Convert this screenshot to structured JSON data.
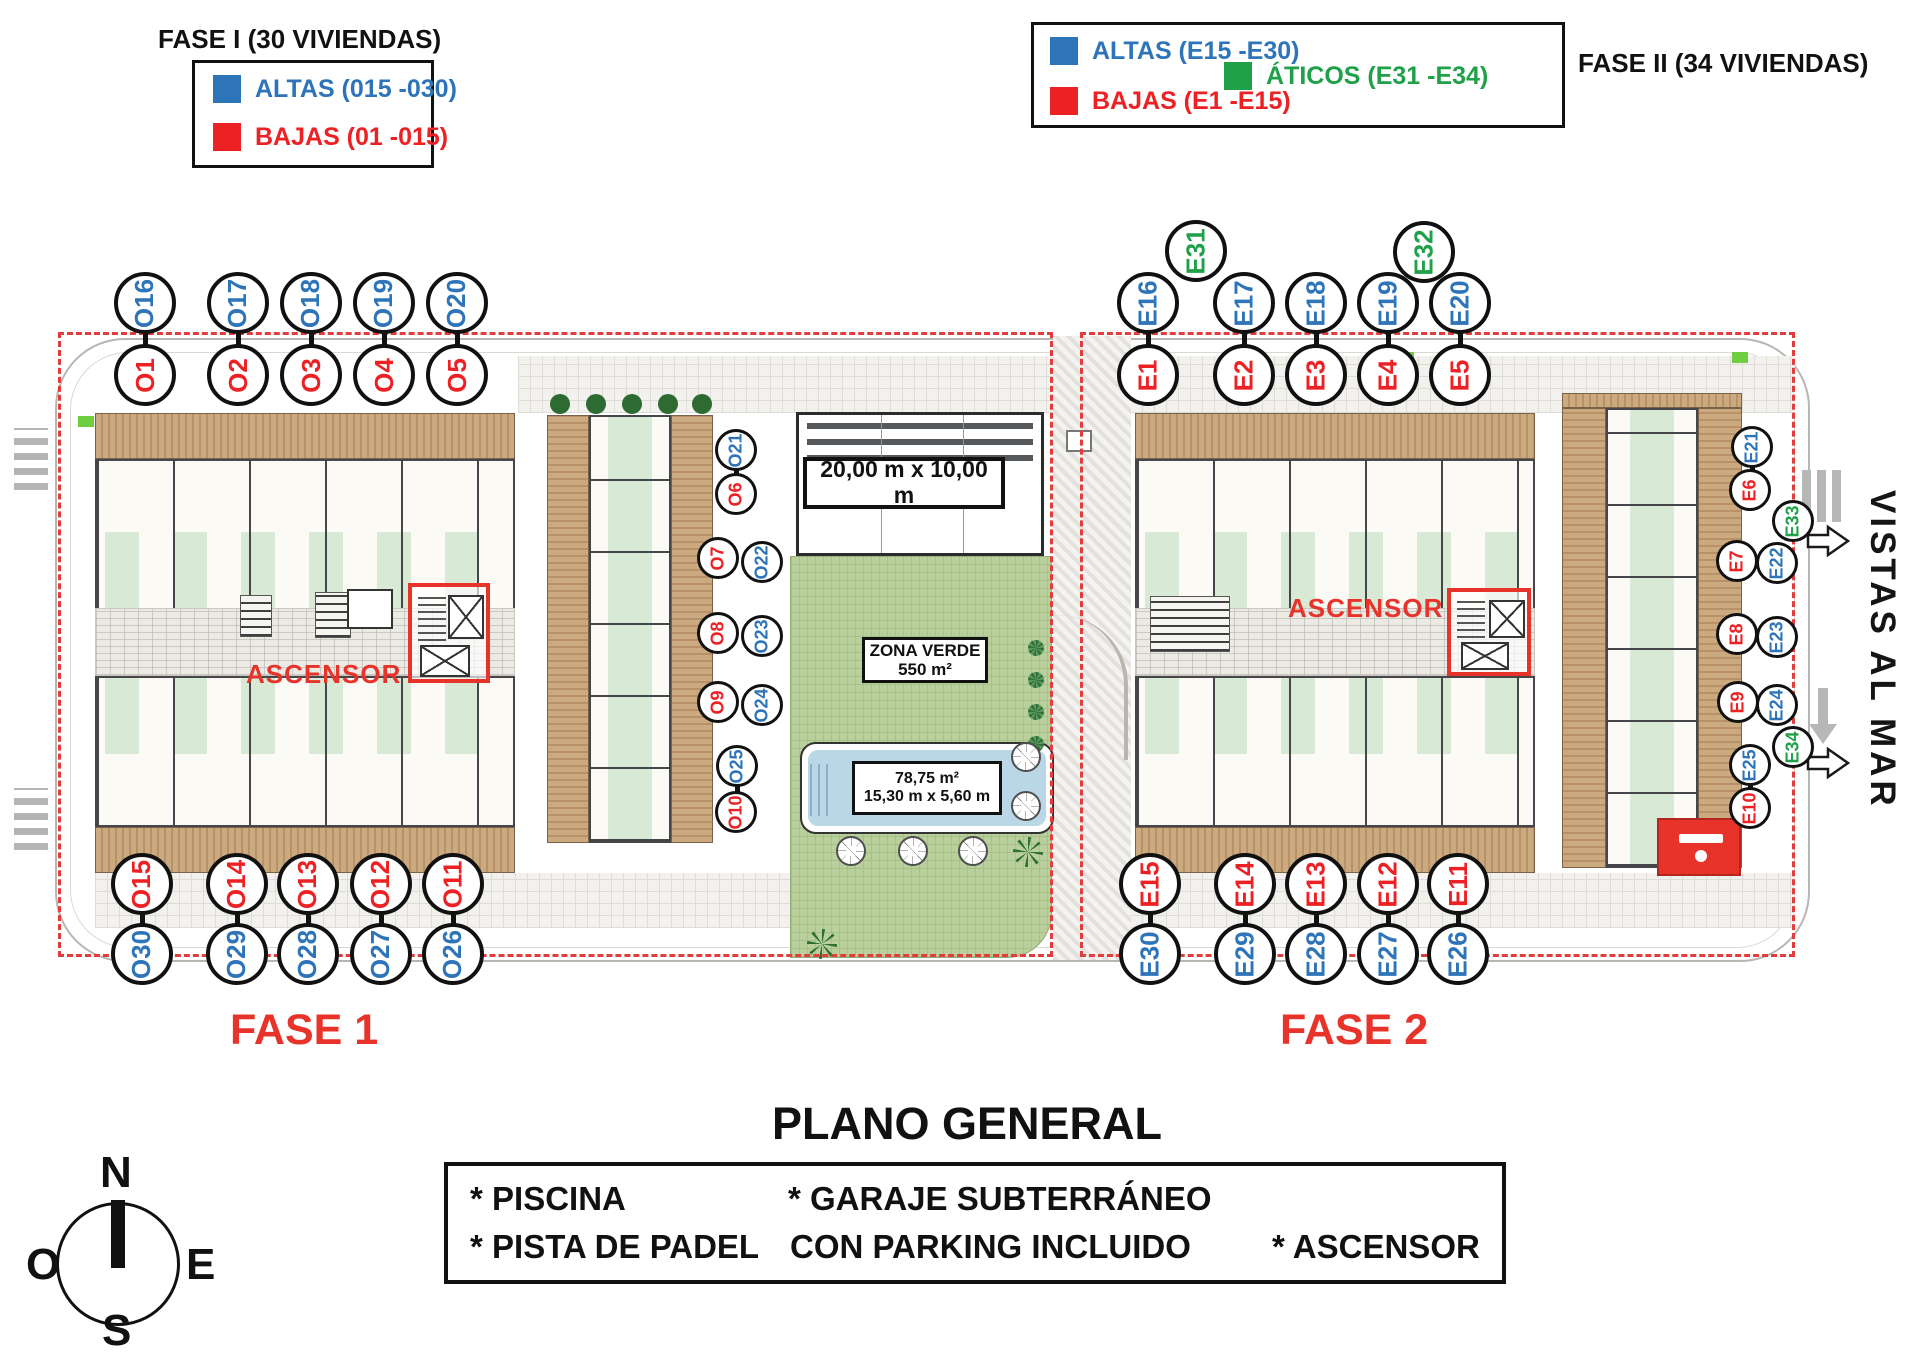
{
  "title": "PLANO GENERAL",
  "palette": {
    "blue": "#2e74b8",
    "red": "#ed2024",
    "green": "#21a04a",
    "dash_red": "#e23c3c",
    "accent_red": "#e8332a"
  },
  "legend_fase1": {
    "title": "FASE I (30 VIVIENDAS)",
    "items": [
      {
        "label": "ALTAS (015 -030)",
        "color": "blue"
      },
      {
        "label": "BAJAS (01 -015)",
        "color": "red"
      }
    ]
  },
  "legend_fase2": {
    "title": "FASE II (34 VIVIENDAS)",
    "items": [
      {
        "label": "ALTAS (E15 -E30)",
        "color": "blue"
      },
      {
        "label": "BAJAS (E1 -E15)",
        "color": "red"
      },
      {
        "label": "ÁTICOS (E31 -E34)",
        "color": "green"
      }
    ]
  },
  "plan": {
    "fase1": "FASE 1",
    "fase2": "FASE 2",
    "ascensor_f1": "ASCENSOR",
    "ascensor_f2": "ASCENSOR",
    "vistas": "VISTAS AL MAR",
    "padel_dim": "20,00 m x 10,00 m",
    "zona_verde": "ZONA VERDE",
    "zona_area": "550 m²",
    "pool_area": "78,75 m²",
    "pool_dim": "15,30 m x 5,60 m"
  },
  "footer_box": {
    "piscina": "* PISCINA",
    "garaje": "* GARAJE SUBTERRÁNEO",
    "pista": "* PISTA DE PADEL",
    "parking": "CON PARKING INCLUIDO",
    "ascensor": "* ASCENSOR"
  },
  "compass": {
    "n": "N",
    "e": "E",
    "s": "S",
    "o": "O"
  },
  "unit_circles": [
    {
      "id": "O16",
      "x": 145,
      "y": 303,
      "r": 31,
      "color": "blue"
    },
    {
      "id": "O1",
      "x": 145,
      "y": 375,
      "r": 31,
      "color": "red"
    },
    {
      "id": "O17",
      "x": 238,
      "y": 303,
      "r": 31,
      "color": "blue"
    },
    {
      "id": "O2",
      "x": 238,
      "y": 375,
      "r": 31,
      "color": "red"
    },
    {
      "id": "O18",
      "x": 311,
      "y": 303,
      "r": 31,
      "color": "blue"
    },
    {
      "id": "O3",
      "x": 311,
      "y": 375,
      "r": 31,
      "color": "red"
    },
    {
      "id": "O19",
      "x": 384,
      "y": 303,
      "r": 31,
      "color": "blue"
    },
    {
      "id": "O4",
      "x": 384,
      "y": 375,
      "r": 31,
      "color": "red"
    },
    {
      "id": "O20",
      "x": 457,
      "y": 303,
      "r": 31,
      "color": "blue"
    },
    {
      "id": "O5",
      "x": 457,
      "y": 375,
      "r": 31,
      "color": "red"
    },
    {
      "id": "O21",
      "x": 736,
      "y": 450,
      "r": 21,
      "color": "blue"
    },
    {
      "id": "O6",
      "x": 736,
      "y": 494,
      "r": 21,
      "color": "red"
    },
    {
      "id": "O7",
      "x": 718,
      "y": 558,
      "r": 21,
      "color": "red"
    },
    {
      "id": "O22",
      "x": 762,
      "y": 562,
      "r": 21,
      "color": "blue"
    },
    {
      "id": "O8",
      "x": 718,
      "y": 633,
      "r": 21,
      "color": "red"
    },
    {
      "id": "O23",
      "x": 762,
      "y": 636,
      "r": 21,
      "color": "blue"
    },
    {
      "id": "O9",
      "x": 718,
      "y": 702,
      "r": 21,
      "color": "red"
    },
    {
      "id": "O24",
      "x": 762,
      "y": 705,
      "r": 21,
      "color": "blue"
    },
    {
      "id": "O25",
      "x": 737,
      "y": 766,
      "r": 21,
      "color": "blue"
    },
    {
      "id": "O10",
      "x": 736,
      "y": 812,
      "r": 21,
      "color": "red"
    },
    {
      "id": "O15",
      "x": 142,
      "y": 884,
      "r": 31,
      "color": "red"
    },
    {
      "id": "O30",
      "x": 142,
      "y": 954,
      "r": 31,
      "color": "blue"
    },
    {
      "id": "O14",
      "x": 237,
      "y": 884,
      "r": 31,
      "color": "red"
    },
    {
      "id": "O29",
      "x": 237,
      "y": 954,
      "r": 31,
      "color": "blue"
    },
    {
      "id": "O13",
      "x": 308,
      "y": 884,
      "r": 31,
      "color": "red"
    },
    {
      "id": "O28",
      "x": 308,
      "y": 954,
      "r": 31,
      "color": "blue"
    },
    {
      "id": "O12",
      "x": 381,
      "y": 884,
      "r": 31,
      "color": "red"
    },
    {
      "id": "O27",
      "x": 381,
      "y": 954,
      "r": 31,
      "color": "blue"
    },
    {
      "id": "O11",
      "x": 453,
      "y": 884,
      "r": 31,
      "color": "red"
    },
    {
      "id": "O26",
      "x": 453,
      "y": 954,
      "r": 31,
      "color": "blue"
    },
    {
      "id": "E31",
      "x": 1196,
      "y": 251,
      "r": 31,
      "color": "green"
    },
    {
      "id": "E32",
      "x": 1424,
      "y": 252,
      "r": 31,
      "color": "green"
    },
    {
      "id": "E16",
      "x": 1148,
      "y": 303,
      "r": 31,
      "color": "blue"
    },
    {
      "id": "E1",
      "x": 1148,
      "y": 375,
      "r": 31,
      "color": "red"
    },
    {
      "id": "E17",
      "x": 1244,
      "y": 303,
      "r": 31,
      "color": "blue"
    },
    {
      "id": "E2",
      "x": 1244,
      "y": 375,
      "r": 31,
      "color": "red"
    },
    {
      "id": "E18",
      "x": 1316,
      "y": 303,
      "r": 31,
      "color": "blue"
    },
    {
      "id": "E3",
      "x": 1316,
      "y": 375,
      "r": 31,
      "color": "red"
    },
    {
      "id": "E19",
      "x": 1388,
      "y": 303,
      "r": 31,
      "color": "blue"
    },
    {
      "id": "E4",
      "x": 1388,
      "y": 375,
      "r": 31,
      "color": "red"
    },
    {
      "id": "E20",
      "x": 1460,
      "y": 303,
      "r": 31,
      "color": "blue"
    },
    {
      "id": "E5",
      "x": 1460,
      "y": 375,
      "r": 31,
      "color": "red"
    },
    {
      "id": "E21",
      "x": 1752,
      "y": 447,
      "r": 21,
      "color": "blue"
    },
    {
      "id": "E6",
      "x": 1750,
      "y": 490,
      "r": 21,
      "color": "red"
    },
    {
      "id": "E33",
      "x": 1793,
      "y": 521,
      "r": 21,
      "color": "green"
    },
    {
      "id": "E7",
      "x": 1737,
      "y": 561,
      "r": 21,
      "color": "red"
    },
    {
      "id": "E22",
      "x": 1777,
      "y": 563,
      "r": 21,
      "color": "blue"
    },
    {
      "id": "E8",
      "x": 1737,
      "y": 634,
      "r": 21,
      "color": "red"
    },
    {
      "id": "E23",
      "x": 1777,
      "y": 637,
      "r": 21,
      "color": "blue"
    },
    {
      "id": "E9",
      "x": 1738,
      "y": 702,
      "r": 21,
      "color": "red"
    },
    {
      "id": "E24",
      "x": 1777,
      "y": 705,
      "r": 21,
      "color": "blue"
    },
    {
      "id": "E34",
      "x": 1793,
      "y": 747,
      "r": 21,
      "color": "green"
    },
    {
      "id": "E25",
      "x": 1750,
      "y": 765,
      "r": 21,
      "color": "blue"
    },
    {
      "id": "E10",
      "x": 1750,
      "y": 808,
      "r": 21,
      "color": "red"
    },
    {
      "id": "E15",
      "x": 1150,
      "y": 884,
      "r": 31,
      "color": "red"
    },
    {
      "id": "E30",
      "x": 1150,
      "y": 954,
      "r": 31,
      "color": "blue"
    },
    {
      "id": "E14",
      "x": 1245,
      "y": 884,
      "r": 31,
      "color": "red"
    },
    {
      "id": "E29",
      "x": 1245,
      "y": 954,
      "r": 31,
      "color": "blue"
    },
    {
      "id": "E13",
      "x": 1316,
      "y": 884,
      "r": 31,
      "color": "red"
    },
    {
      "id": "E28",
      "x": 1316,
      "y": 954,
      "r": 31,
      "color": "blue"
    },
    {
      "id": "E12",
      "x": 1388,
      "y": 884,
      "r": 31,
      "color": "red"
    },
    {
      "id": "E27",
      "x": 1388,
      "y": 954,
      "r": 31,
      "color": "blue"
    },
    {
      "id": "E11",
      "x": 1458,
      "y": 884,
      "r": 31,
      "color": "red"
    },
    {
      "id": "E26",
      "x": 1458,
      "y": 954,
      "r": 31,
      "color": "blue"
    }
  ]
}
